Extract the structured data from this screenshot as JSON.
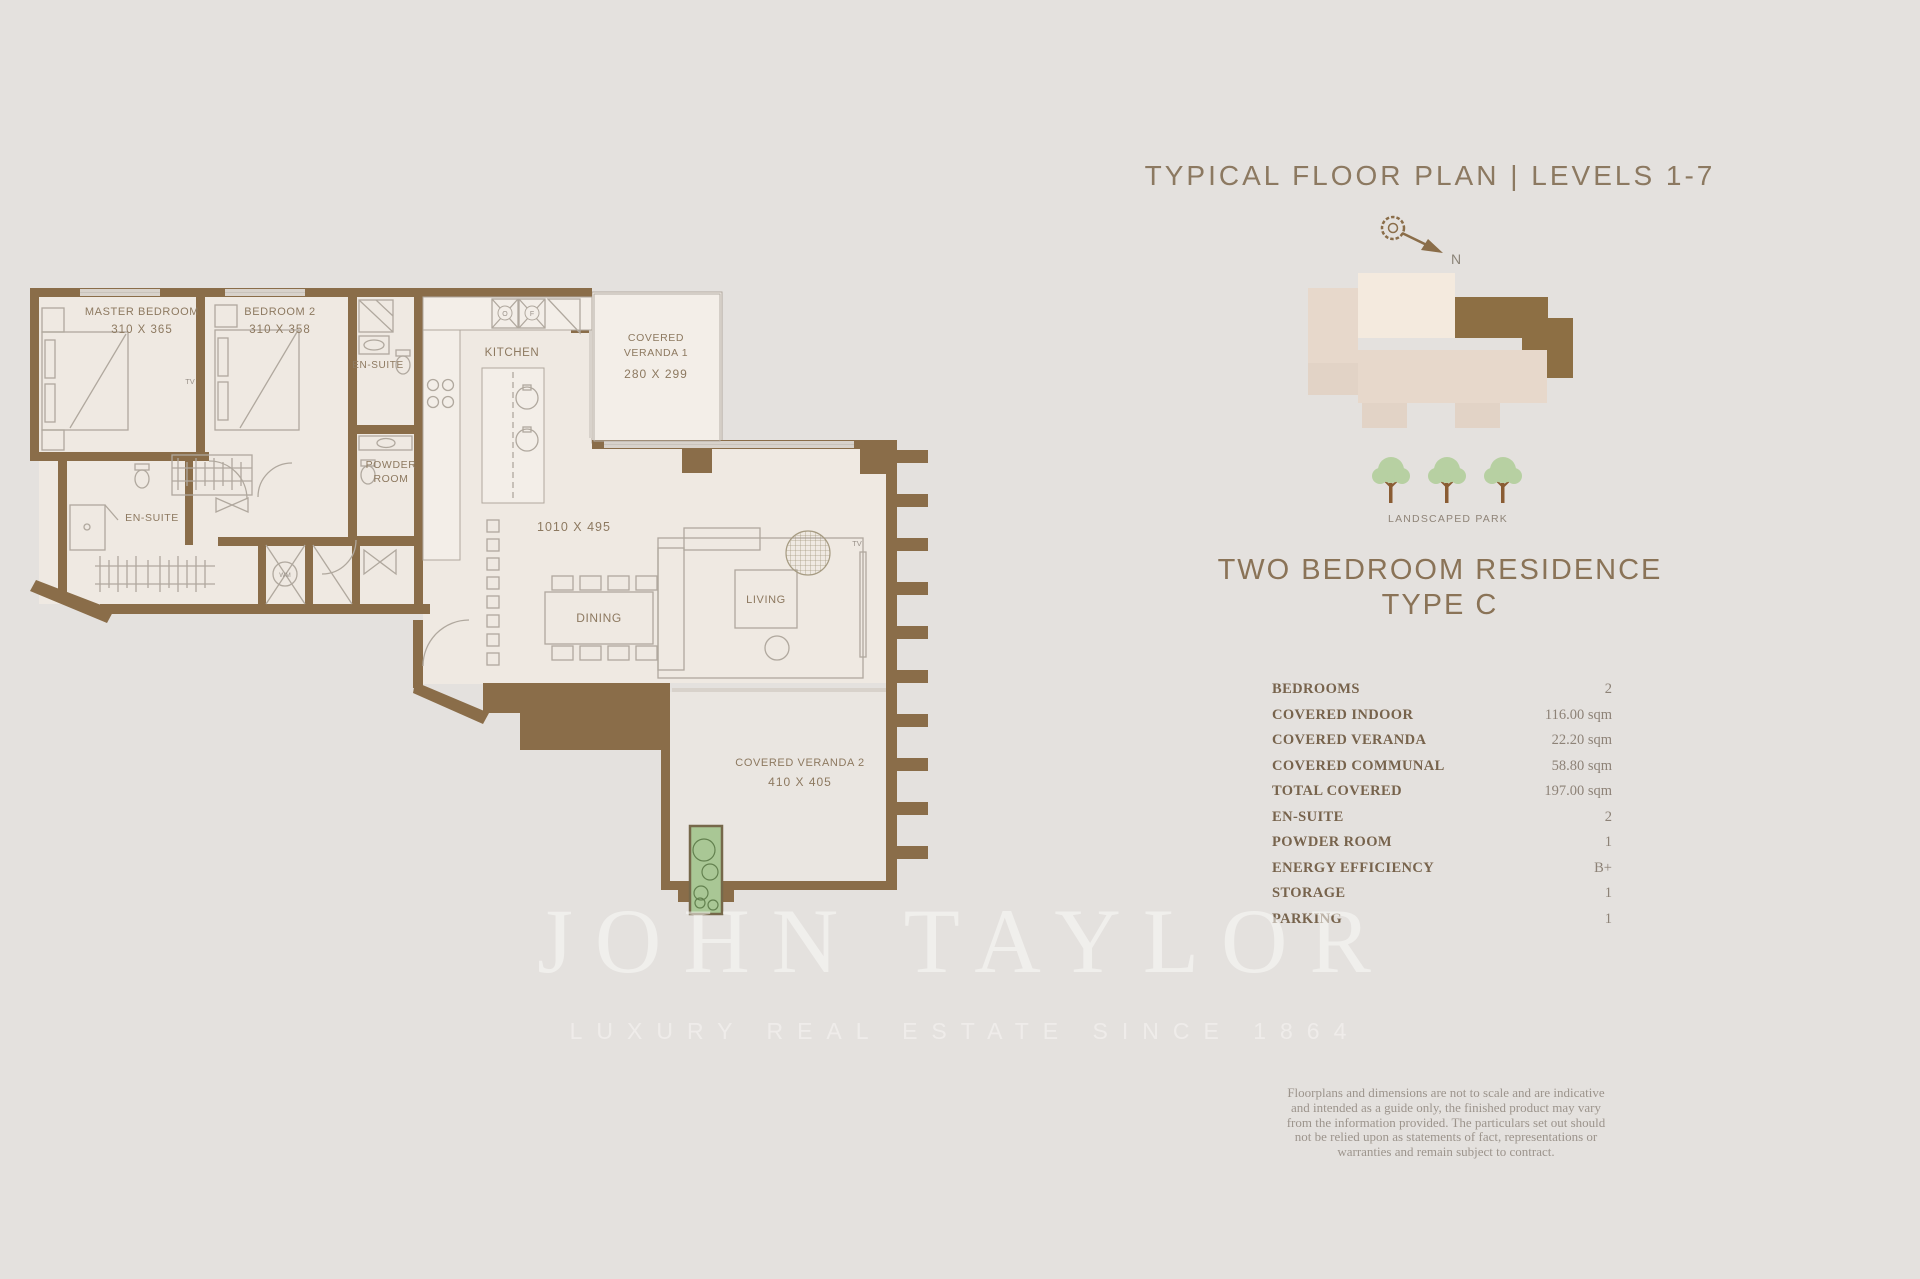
{
  "page": {
    "background": "#e4e1de",
    "width": 1920,
    "height": 1279
  },
  "header": {
    "title": "TYPICAL FLOOR PLAN | LEVELS 1-7",
    "compass_direction": "N"
  },
  "key_plan": {
    "park_label": "LANDSCAPED PARK",
    "highlight_color": "#8d6f44"
  },
  "residence": {
    "title_line1": "TWO BEDROOM RESIDENCE",
    "title_line2": "TYPE C"
  },
  "specs": {
    "rows": [
      {
        "label": "BEDROOMS",
        "value": "2"
      },
      {
        "label": "COVERED INDOOR",
        "value": "116.00 sqm"
      },
      {
        "label": "COVERED VERANDA",
        "value": "22.20 sqm"
      },
      {
        "label": "COVERED COMMUNAL",
        "value": "58.80 sqm"
      },
      {
        "label": "TOTAL COVERED",
        "value": "197.00 sqm"
      },
      {
        "label": "EN-SUITE",
        "value": "2"
      },
      {
        "label": "POWDER ROOM",
        "value": "1"
      },
      {
        "label": "ENERGY EFFICIENCY",
        "value": "B+"
      },
      {
        "label": "STORAGE",
        "value": "1"
      },
      {
        "label": "PARKING",
        "value": "1"
      }
    ]
  },
  "disclaimer": {
    "text": "Floorplans and dimensions are not to scale and are indicative and intended as a guide only, the finished product may vary from the information provided. The particulars set out should not be relied upon as statements of fact, representations or warranties and remain subject to contract."
  },
  "watermark": {
    "brand": "JOHN TAYLOR",
    "tagline": "LUXURY REAL ESTATE SINCE 1864"
  },
  "floor_plan": {
    "master_bedroom": {
      "name": "MASTER BEDROOM",
      "dims": "310 X 365"
    },
    "bedroom_2": {
      "name": "BEDROOM 2",
      "dims": "310 X 358"
    },
    "ensuite_master": "EN-SUITE",
    "ensuite_2": "EN-SUITE",
    "powder_room": {
      "line1": "POWDER",
      "line2": "ROOM"
    },
    "kitchen": "KITCHEN",
    "great_room_dims": "1010 X 495",
    "dining": "DINING",
    "living": "LIVING",
    "veranda_1": {
      "line1": "COVERED",
      "line2": "VERANDA 1",
      "dims": "280 X 299"
    },
    "veranda_2": {
      "name": "COVERED VERANDA 2",
      "dims": "410 X 405"
    },
    "tv_label": "TV",
    "washing_machine_label": "WM",
    "oven_label": "O",
    "fridge_label": "F"
  },
  "colors": {
    "wall": "#8a6d49",
    "floor": "#efe9e2",
    "accent_text": "#8c7961",
    "tree_green": "#b7d0a2",
    "planter_green": "#a9c795"
  }
}
